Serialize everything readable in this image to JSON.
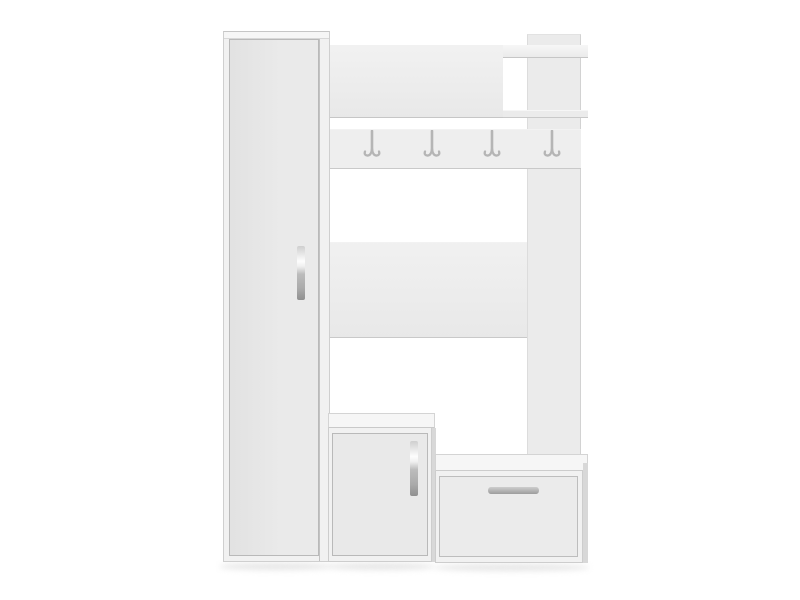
{
  "scene": {
    "type": "product-photo",
    "subject": "White hallway hall-tree furniture set on plain white background",
    "background": "plain white studio background",
    "hook_count": 4,
    "parts": [
      {
        "name": "wardrobe-cabinet",
        "kind": "tall cabinet with full-height door and vertical metal handle"
      },
      {
        "name": "top-shelf-panel",
        "kind": "upper horizontal shelf panel"
      },
      {
        "name": "open-cubby",
        "kind": "open shelf compartment at top right formed by two boards"
      },
      {
        "name": "right-upright-panel",
        "kind": "vertical side panel"
      },
      {
        "name": "coat-rack-rail",
        "kind": "hook rail with four chrome double hooks"
      },
      {
        "name": "middle-back-panel",
        "kind": "horizontal back panel at mid height"
      },
      {
        "name": "shoe-cabinet",
        "kind": "lower cabinet with door and vertical metal handle"
      },
      {
        "name": "storage-bench",
        "kind": "low bench unit with drawer and horizontal metal handle"
      }
    ]
  },
  "palette": {
    "background": "#ffffff",
    "panel": "#ededed",
    "rail": "#eeeeee",
    "upright": "#ebebeb",
    "board": "#efefef",
    "cabinet_front": "#f1f1f1",
    "door": "#e9e9e9",
    "drawer": "#ebebeb",
    "top_face": "#f6f6f6",
    "side_face": "#d8d8d8",
    "metal": "#b5b5b5",
    "shadow": "#dedede"
  }
}
